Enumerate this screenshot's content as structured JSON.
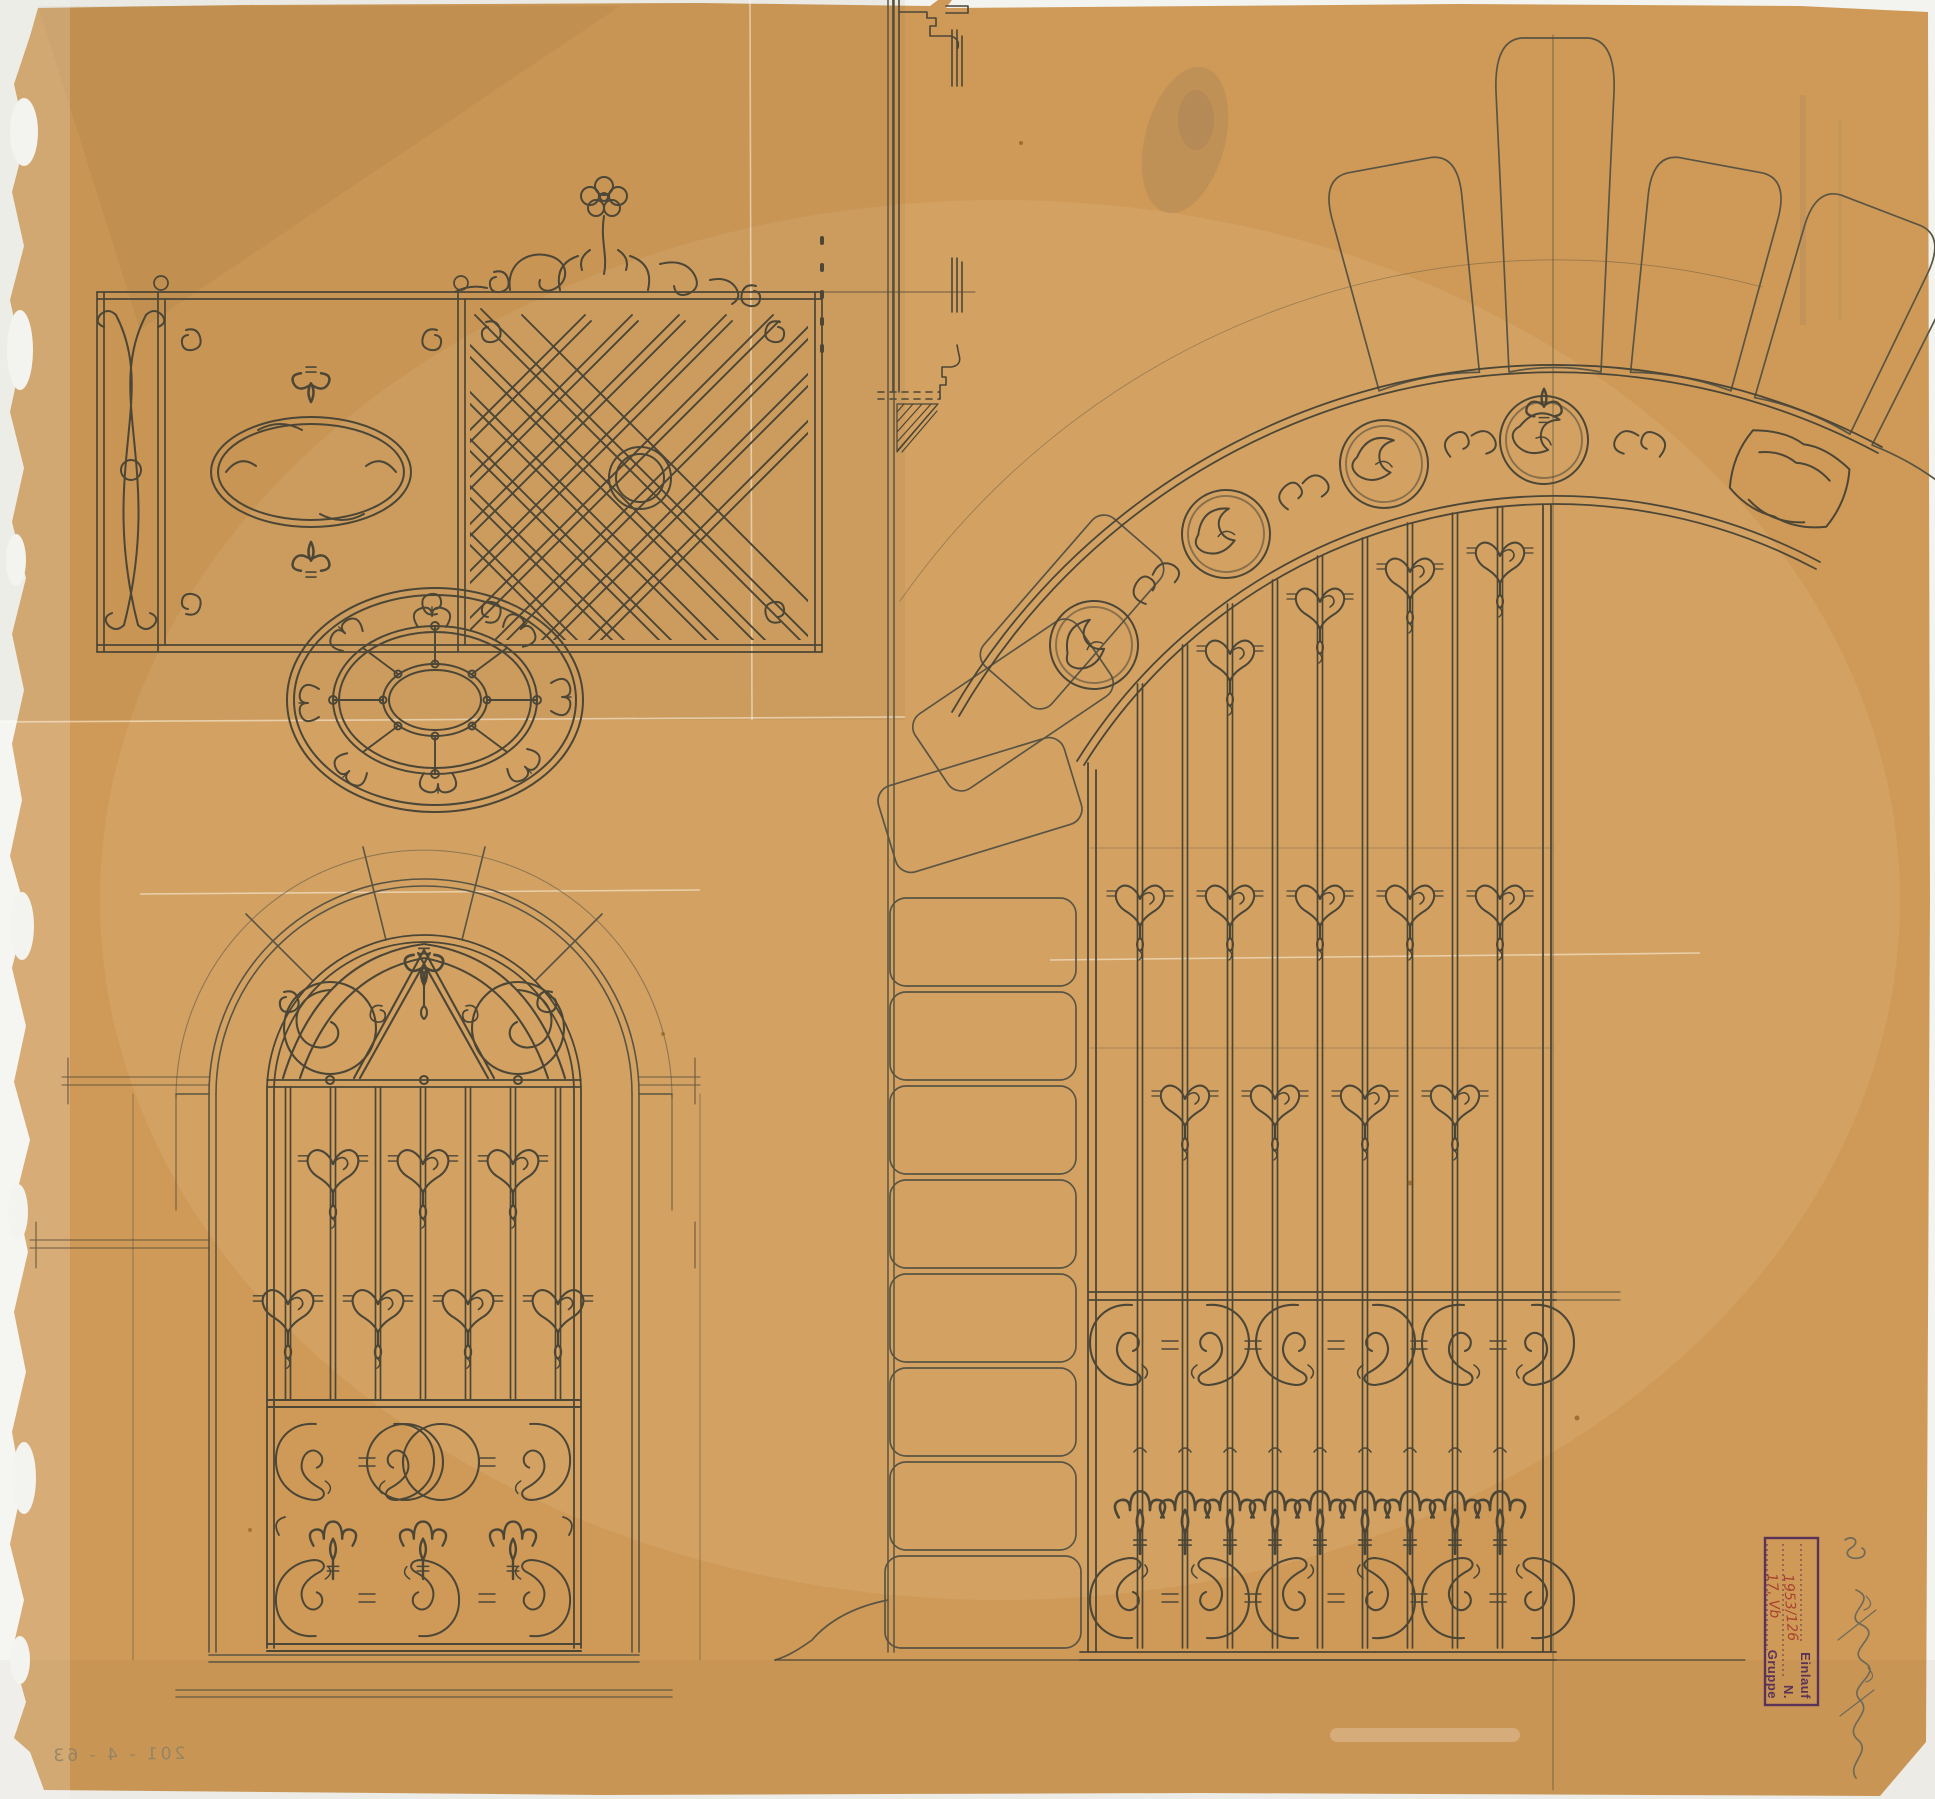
{
  "document": {
    "type": "architectural design drawing (scanned sheet)",
    "medium": "pencil on orange tracing paper",
    "subject": "wrought-iron gate (half elevation with stone arch), arched window grille, railing frieze, oval grille ornament",
    "paper_color": "#cf9a58",
    "pencil_color": "#4c4636",
    "scan_background_color": "#f3f3ef"
  },
  "stamp": {
    "mirrored": true,
    "orientation": "rotated 90°, seen through back of tracing paper",
    "row_einlauf_label": "Einlauf",
    "row_n_label": "N.",
    "row_n_value": "1953/126",
    "row_gruppe_label": "Gruppe",
    "row_gruppe_value": "17, Vb",
    "ink_color": "#5a3458",
    "handwriting_color": "#a8432e"
  },
  "annotations": {
    "corner_note": "201 - 4 - 63",
    "corner_note_mirrored": true,
    "signature": "illegible mirrored pencil signature"
  }
}
